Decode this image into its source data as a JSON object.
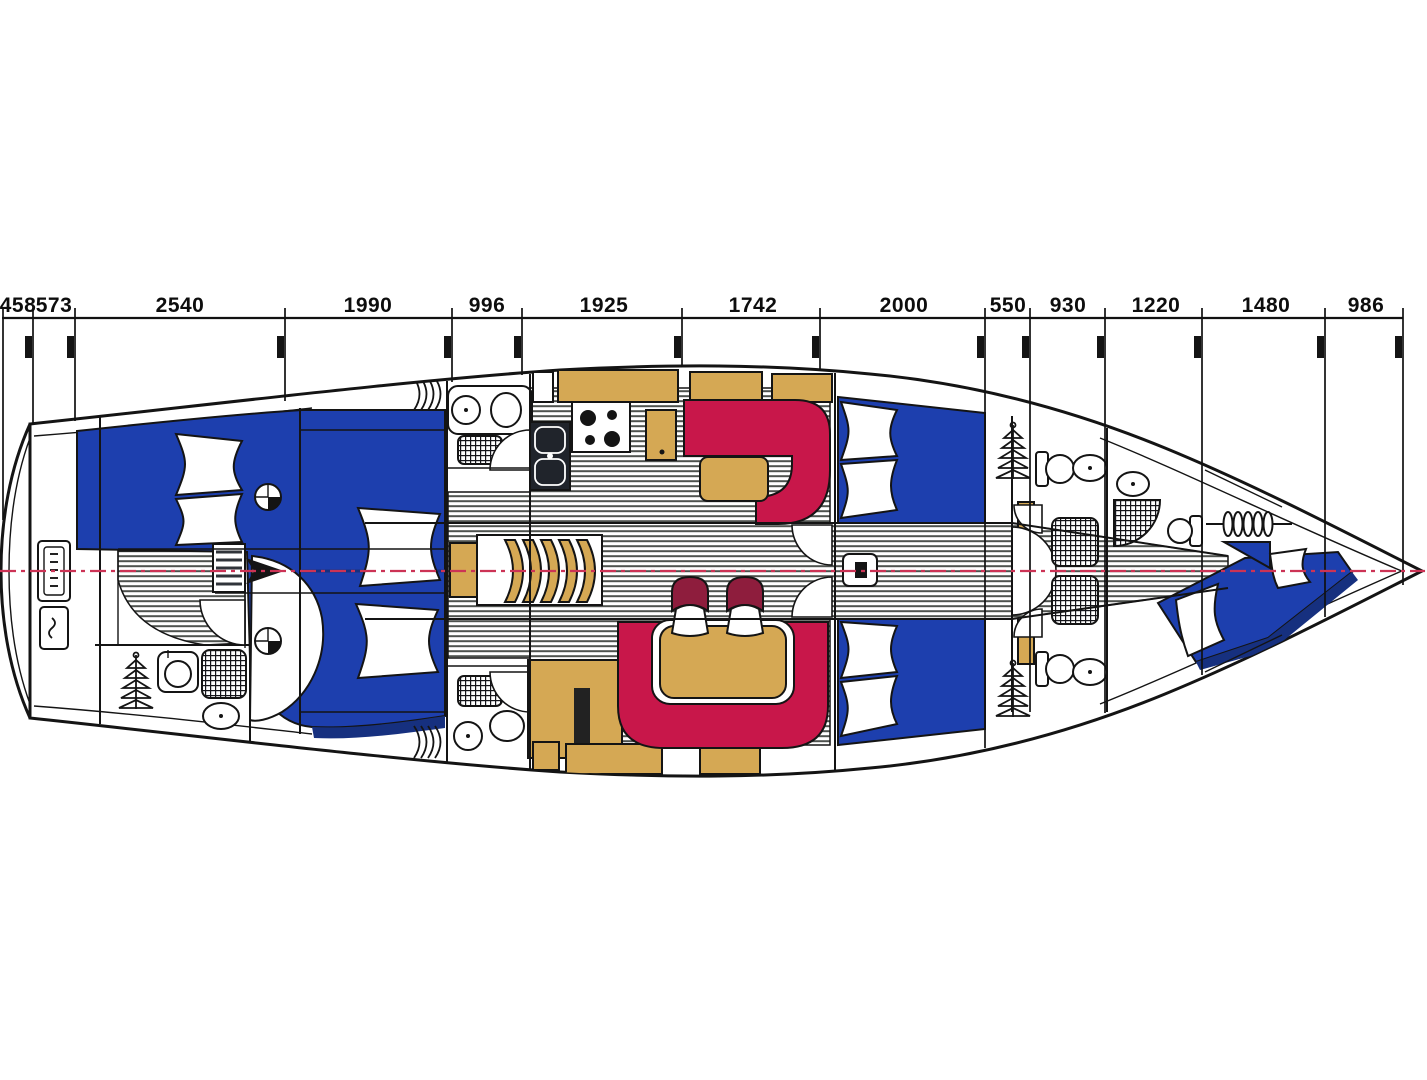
{
  "dims": {
    "labels": [
      "458",
      "573",
      "2540",
      "1990",
      "996",
      "1925",
      "1742",
      "2000",
      "550",
      "930",
      "1220",
      "1480",
      "986"
    ]
  },
  "colors": {
    "berth_blue": "#1d3fae",
    "berth_blue_dark": "#16307f",
    "sofa_red": "#c8174a",
    "chair_maroon": "#8e1d3d",
    "wood_tan": "#d5a854",
    "stripe_gray": "#4e524e",
    "centerline_red": "#cc3355",
    "ink": "#141414"
  },
  "icons": {
    "companionway_steps": "curved-treads",
    "companionway_ladder": "nested-arcs",
    "hanging_locker": "stacked-hangers",
    "toilet": "oval-bowl",
    "washbasin": "circle-in-square",
    "stove": "four-burner-circles",
    "double_sink": "two-basins",
    "shower_grate": "grid",
    "anchor_windlass": "chain-coil",
    "mast": "black-square-post",
    "steering_gear": "winch-circles-and-arrow"
  }
}
